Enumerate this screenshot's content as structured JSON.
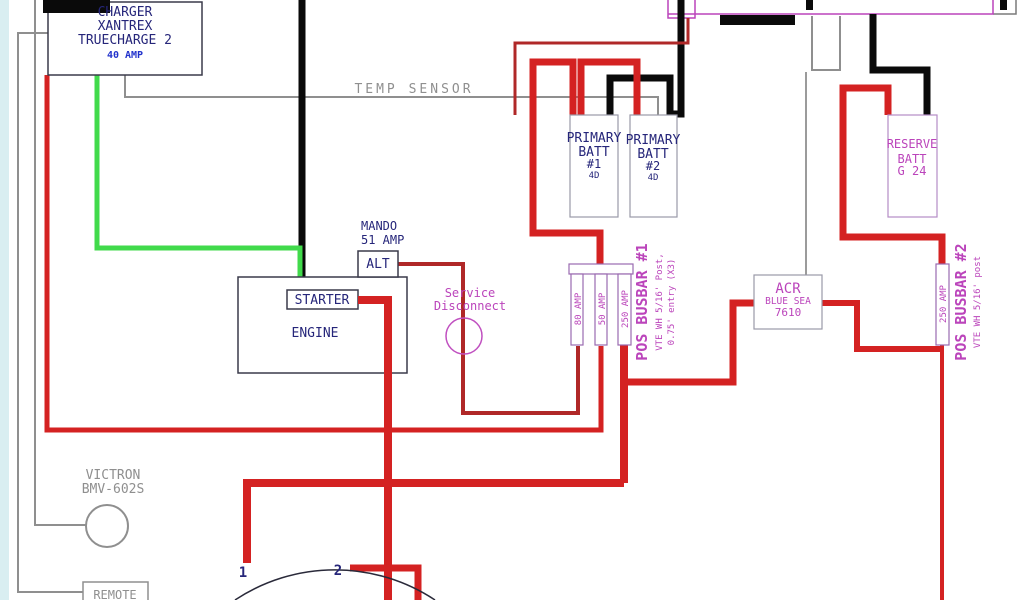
{
  "components": {
    "charger": {
      "line1": "CHARGER",
      "line2": "XANTREX",
      "line3": "TRUECHARGE 2",
      "rating": "40 AMP"
    },
    "temp_sensor": {
      "label": "TEMP SENSOR"
    },
    "primary_batt_1": {
      "line1": "PRIMARY",
      "line2": "BATT",
      "line3": "#1",
      "size": "4D"
    },
    "primary_batt_2": {
      "line1": "PRIMARY",
      "line2": "BATT",
      "line3": "#2",
      "size": "4D"
    },
    "reserve_batt": {
      "line1": "RESERVE",
      "line2": "BATT",
      "line3": "G 24"
    },
    "alternator": {
      "make": "MANDO",
      "rating": "51 AMP",
      "label": "ALT"
    },
    "engine": {
      "label": "ENGINE",
      "starter": "STARTER"
    },
    "service_disconnect": {
      "line1": "Service",
      "line2": "Disconnect"
    },
    "busbar_1": {
      "fuse1": "80 AMP",
      "fuse2": "50 AMP",
      "fuse3": "250 AMP",
      "name": "POS BUSBAR #1",
      "spec1": "VTE WH 5/16' Post,",
      "spec2": "0.75' entry (X3)"
    },
    "acr": {
      "line1": "ACR",
      "line2": "BLUE SEA",
      "line3": "7610"
    },
    "busbar_2": {
      "fuse": "250 AMP",
      "name": "POS BUSBAR #2",
      "spec": "VTE WH 5/16' post"
    },
    "battery_monitor": {
      "line1": "VICTRON",
      "line2": "BMV-602S"
    },
    "remote": {
      "label": "REMOTE"
    },
    "switch": {
      "terminal1": "1",
      "terminal2": "2"
    }
  },
  "colors": {
    "positive_wire": "#d42222",
    "positive_wire_dark": "#b02828",
    "negative_wire": "#0a0a0a",
    "charge_wire_green": "#41da4b",
    "sense_wire_gray": "#8f8f8f",
    "label_navy": "#26267a",
    "label_magenta": "#bb44bb",
    "label_blue": "#2233cc",
    "edge_strip": "#d9eef1"
  }
}
